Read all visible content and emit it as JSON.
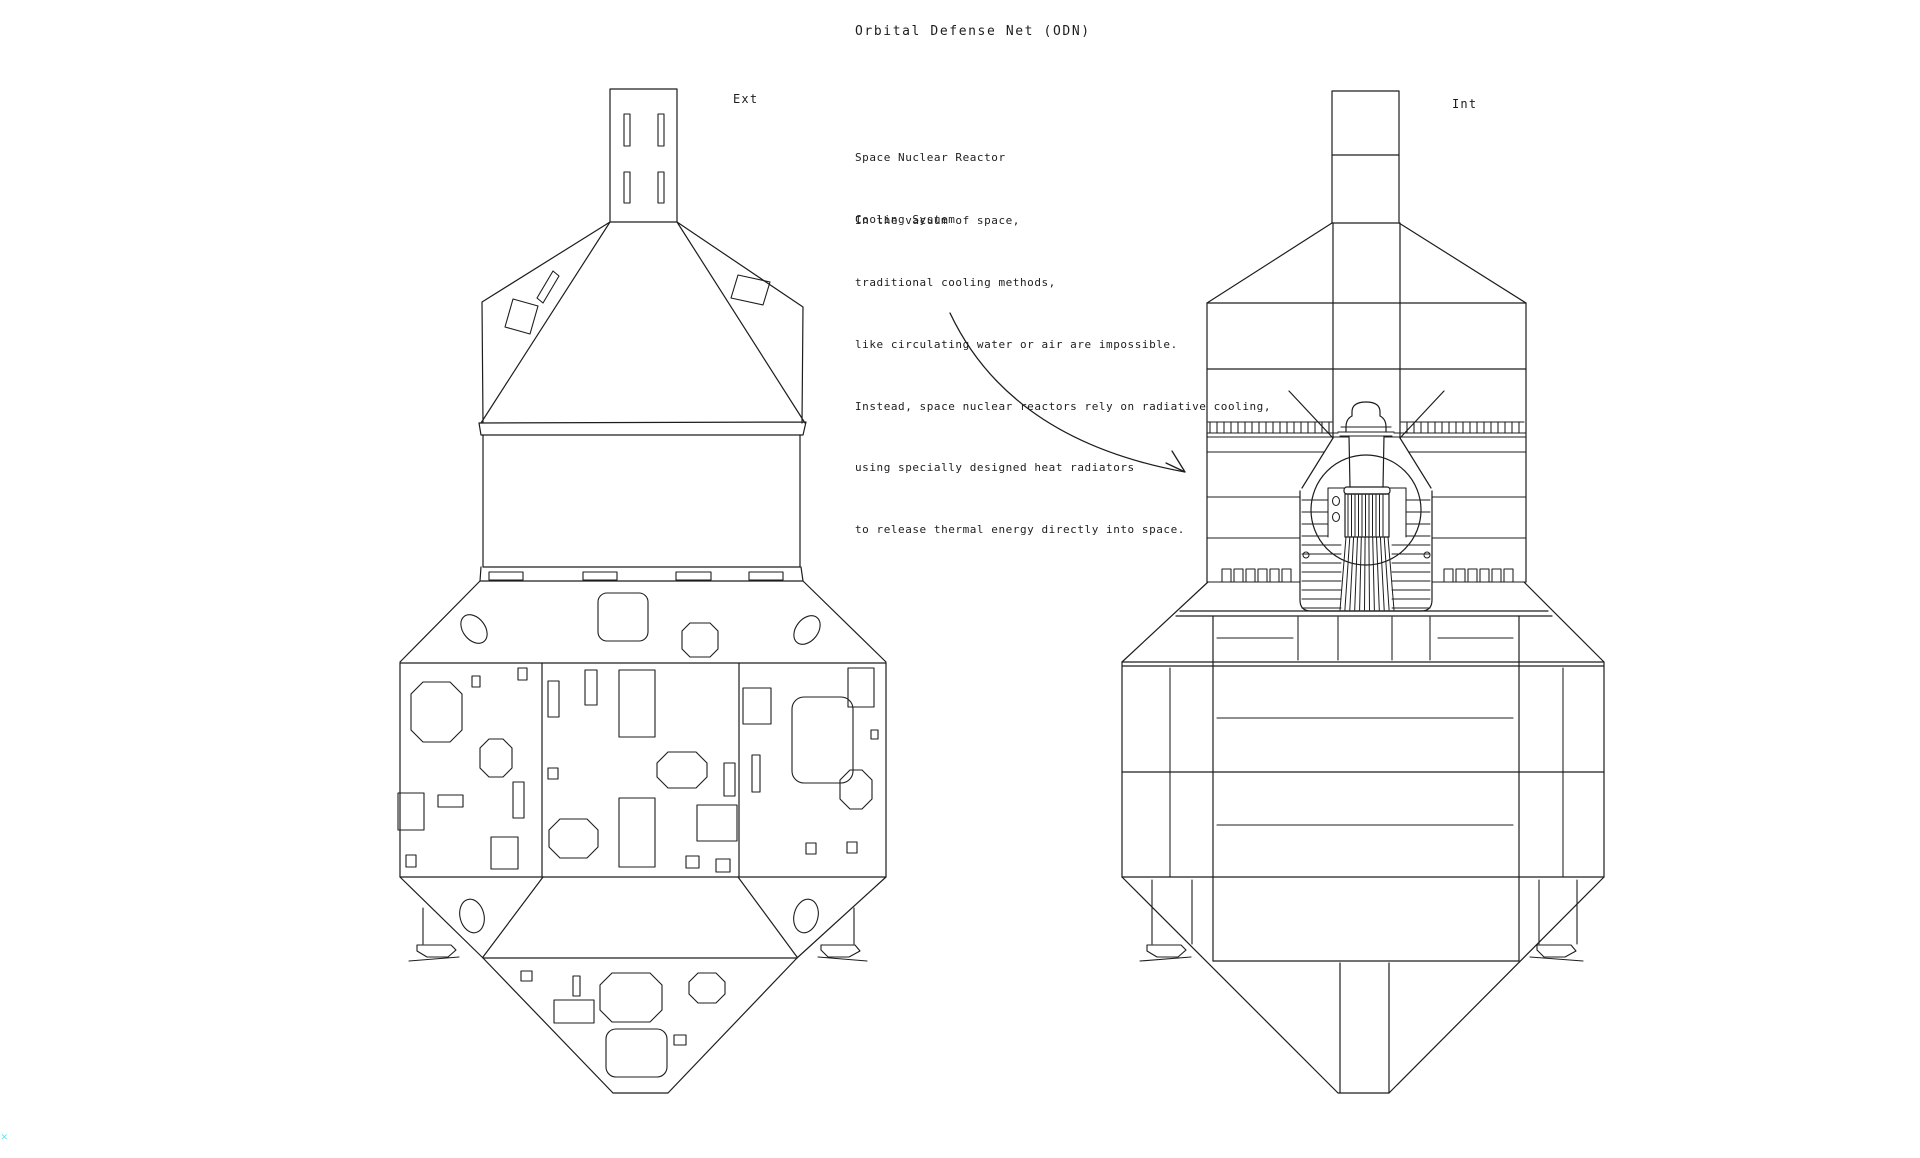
{
  "title": "Orbital Defense Net (ODN)",
  "views": {
    "exterior_label": "Ext",
    "interior_label": "Int"
  },
  "annotation": {
    "heading": [
      "Space Nuclear Reactor",
      "Cooling System"
    ],
    "body": [
      "In the vacuum of space,",
      "traditional cooling methods,",
      "like circulating water or air are impossible.",
      "Instead, space nuclear reactors rely on radiative cooling,",
      "using specially designed heat radiators",
      "to release thermal energy directly into space."
    ]
  },
  "corner_mark_glyph": "✕",
  "colors": {
    "background": "#ffffff",
    "line": "#1d1d1d",
    "corner_mark": "#5ee6f0"
  }
}
